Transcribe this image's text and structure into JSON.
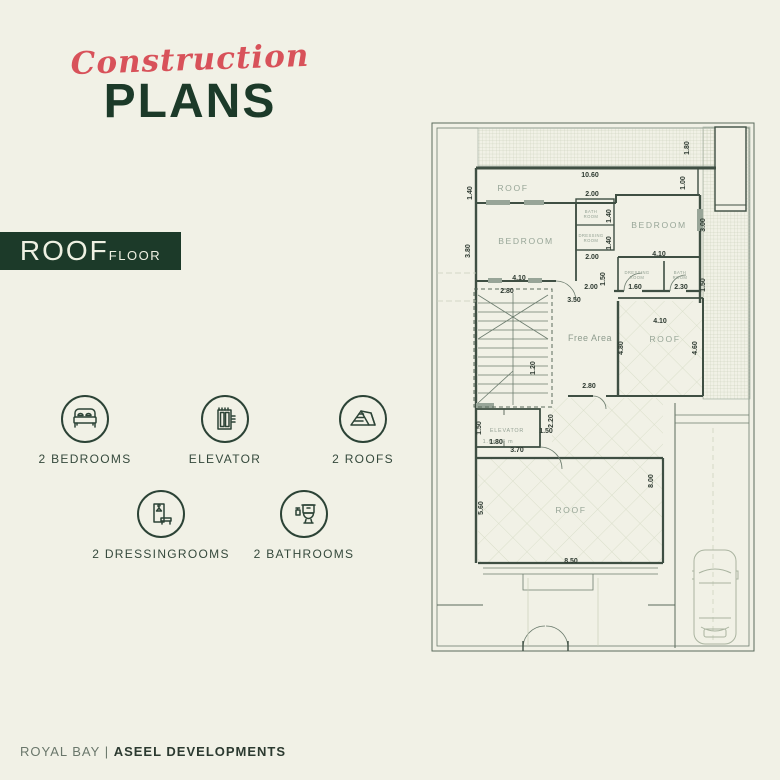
{
  "title": {
    "script": "Construction",
    "main": "PLANS"
  },
  "floor_tag": {
    "name": "ROOF",
    "suffix": "FLOOR"
  },
  "legend": {
    "row1": [
      {
        "icon": "bed-icon",
        "label": "2 BEDROOMS"
      },
      {
        "icon": "elevator-icon",
        "label": "ELEVATOR"
      },
      {
        "icon": "roof-icon",
        "label": "2 ROOFS"
      }
    ],
    "row2": [
      {
        "icon": "dressing-icon",
        "label": "2 DRESSINGROOMS"
      },
      {
        "icon": "toilet-icon",
        "label": "2 BATHROOMS"
      }
    ]
  },
  "footer": {
    "brand": "ROYAL BAY",
    "divider": "|",
    "company": "ASEEL DEVELOPMENTS"
  },
  "colors": {
    "accent_red": "#d8525a",
    "dark_green": "#1c3a29",
    "background": "#f1f1e6",
    "wall": "#3f4f43"
  },
  "plan": {
    "room_labels": [
      {
        "t": "ROOF",
        "x": 85,
        "y": 78,
        "c": "rm"
      },
      {
        "t": "BEDROOM",
        "x": 98,
        "y": 131,
        "c": "rm"
      },
      {
        "t": "BATH",
        "x": 163,
        "y": 100,
        "c": "rs"
      },
      {
        "t": "ROOM",
        "x": 163,
        "y": 105,
        "c": "rs"
      },
      {
        "t": "DRESSING",
        "x": 163,
        "y": 124,
        "c": "rs"
      },
      {
        "t": "ROOM",
        "x": 163,
        "y": 129,
        "c": "rs"
      },
      {
        "t": "BEDROOM",
        "x": 231,
        "y": 115,
        "c": "rm"
      },
      {
        "t": "DRESSING",
        "x": 209,
        "y": 161,
        "c": "rs"
      },
      {
        "t": "ROOM",
        "x": 209,
        "y": 166,
        "c": "rs"
      },
      {
        "t": "BATH",
        "x": 252,
        "y": 161,
        "c": "rs"
      },
      {
        "t": "ROOM",
        "x": 252,
        "y": 166,
        "c": "rs"
      },
      {
        "t": "Free Area",
        "x": 162,
        "y": 228,
        "c": "rf"
      },
      {
        "t": "ROOF",
        "x": 237,
        "y": 229,
        "c": "rm"
      },
      {
        "t": "ELEVATOR",
        "x": 79,
        "y": 319,
        "c": "re"
      },
      {
        "t": "1.6x1.8 m",
        "x": 70,
        "y": 330,
        "c": "re"
      },
      {
        "t": "ROOF",
        "x": 143,
        "y": 400,
        "c": "rm"
      }
    ],
    "dimensions": [
      {
        "t": "10.60",
        "x": 162,
        "y": 64
      },
      {
        "t": "1.40",
        "x": 44,
        "y": 80,
        "r": 1
      },
      {
        "t": "1.00",
        "x": 257,
        "y": 70,
        "r": 1
      },
      {
        "t": "1.80",
        "x": 261,
        "y": 35,
        "r": 1
      },
      {
        "t": "3.80",
        "x": 42,
        "y": 138,
        "r": 1
      },
      {
        "t": "2.00",
        "x": 164,
        "y": 83
      },
      {
        "t": "1.40",
        "x": 183,
        "y": 103,
        "r": 1
      },
      {
        "t": "1.40",
        "x": 183,
        "y": 130,
        "r": 1
      },
      {
        "t": "2.00",
        "x": 164,
        "y": 146
      },
      {
        "t": "3.00",
        "x": 277,
        "y": 112,
        "r": 1
      },
      {
        "t": "4.10",
        "x": 231,
        "y": 143
      },
      {
        "t": "1.50",
        "x": 177,
        "y": 166,
        "r": 1
      },
      {
        "t": "2.00",
        "x": 163,
        "y": 176
      },
      {
        "t": "1.60",
        "x": 207,
        "y": 176
      },
      {
        "t": "2.30",
        "x": 253,
        "y": 176
      },
      {
        "t": "1.50",
        "x": 277,
        "y": 172,
        "r": 1
      },
      {
        "t": "4.10",
        "x": 91,
        "y": 167
      },
      {
        "t": "2.80",
        "x": 79,
        "y": 180
      },
      {
        "t": "3.50",
        "x": 146,
        "y": 189
      },
      {
        "t": "2.80",
        "x": 161,
        "y": 275
      },
      {
        "t": "4.10",
        "x": 232,
        "y": 210
      },
      {
        "t": "4.80",
        "x": 195,
        "y": 235,
        "r": 1
      },
      {
        "t": "4.60",
        "x": 269,
        "y": 235,
        "r": 1
      },
      {
        "t": "1.20",
        "x": 107,
        "y": 255,
        "r": 1
      },
      {
        "t": "1.50",
        "x": 53,
        "y": 315,
        "r": 1
      },
      {
        "t": "1.80",
        "x": 68,
        "y": 331
      },
      {
        "t": "1.50",
        "x": 118,
        "y": 320
      },
      {
        "t": "2.20",
        "x": 125,
        "y": 308,
        "r": 1
      },
      {
        "t": "3.70",
        "x": 89,
        "y": 339
      },
      {
        "t": "5.60",
        "x": 55,
        "y": 395,
        "r": 1
      },
      {
        "t": "8.00",
        "x": 225,
        "y": 368,
        "r": 1
      },
      {
        "t": "8.50",
        "x": 143,
        "y": 450
      }
    ]
  }
}
